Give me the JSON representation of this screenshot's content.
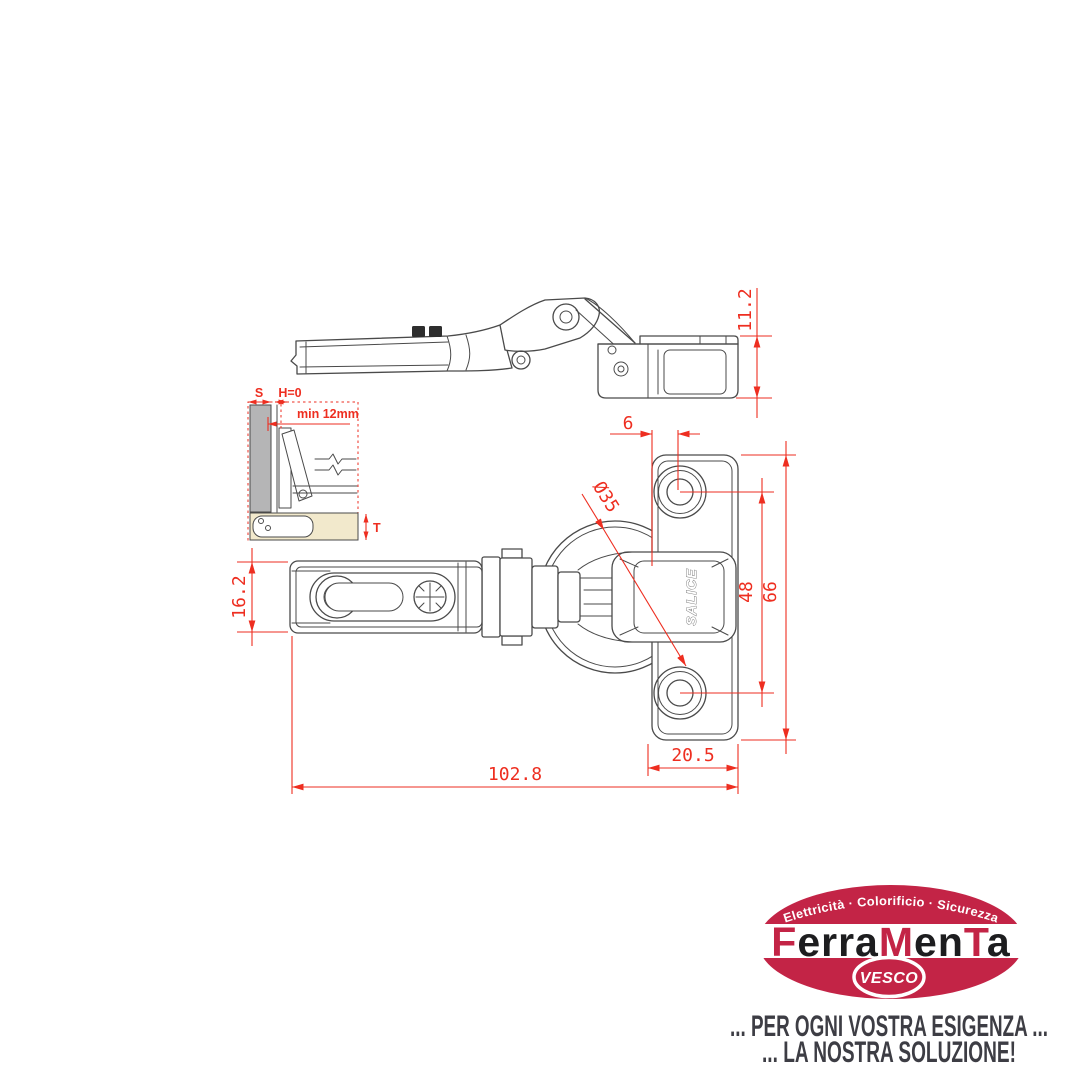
{
  "drawing": {
    "part_brand": "SALICE",
    "dims": {
      "side_height": "11.2",
      "hole_offset": "6",
      "cup_diameter": "Ø35",
      "hole_spacing": "48",
      "plate_height": "66",
      "arm_width": "16.2",
      "plate_width": "20.5",
      "overall_length": "102.8"
    },
    "inset": {
      "overlay_label": "S",
      "gap_label": "H=0",
      "depth_label": "min 12mm",
      "thickness_label": "T"
    },
    "colors": {
      "dimension_red": "#ee2e20",
      "line_gray": "#4a4a4a"
    }
  },
  "logo": {
    "arc_text": "Elettricità · Colorificio · Sicurezza",
    "brand_segments": [
      {
        "text": "F"
      },
      {
        "text": "erra"
      },
      {
        "text": "M"
      },
      {
        "text": "en"
      },
      {
        "text": "T"
      },
      {
        "text": "a"
      }
    ],
    "badge": "VESCO",
    "tagline_line1": "... PER OGNI VOSTRA ESIGENZA ...",
    "tagline_line2": "... LA NOSTRA SOLUZIONE!",
    "colors": {
      "red": "#c32446",
      "text": "#3d3d44"
    }
  }
}
